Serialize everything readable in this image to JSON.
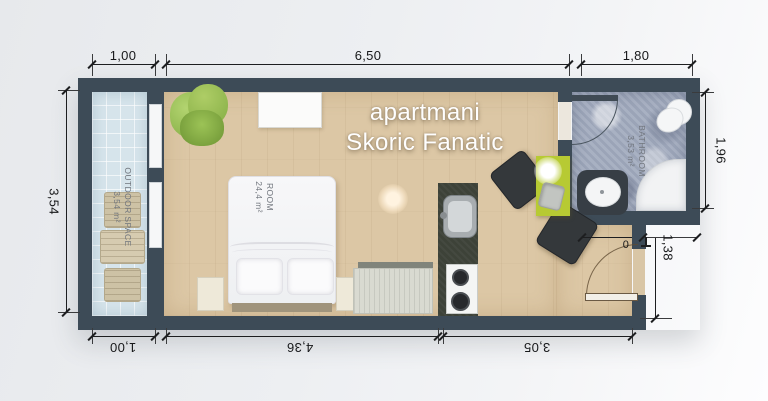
{
  "watermark": {
    "line1": "apartmani",
    "line2": "Skoric Fanatic"
  },
  "rooms": {
    "outdoor": {
      "name": "OUTDOOR SPACE",
      "area": "3,54 m²"
    },
    "main": {
      "name": "ROOM",
      "area": "24,4 m²"
    },
    "bathroom": {
      "name": "BATHROOM",
      "area": "3,53 m²"
    }
  },
  "dimensions": {
    "top": [
      "1,00",
      "6,50",
      "1,80"
    ],
    "bottom": [
      "1,00",
      "4,36",
      "3,05"
    ],
    "left": [
      "3,54"
    ],
    "right": [
      "1,96",
      "1,38"
    ],
    "door_fragment": "0"
  },
  "colors": {
    "wall": "#3d4b57",
    "room_floor": "#dcc7a5",
    "outdoor_floor": "#d6e4eb",
    "bathroom_floor": "#a2abbe",
    "kitchen_counter": "#3d4238",
    "table_accent": "#b7ca33",
    "dimension_text": "#17181a",
    "background": "#edeff2"
  }
}
